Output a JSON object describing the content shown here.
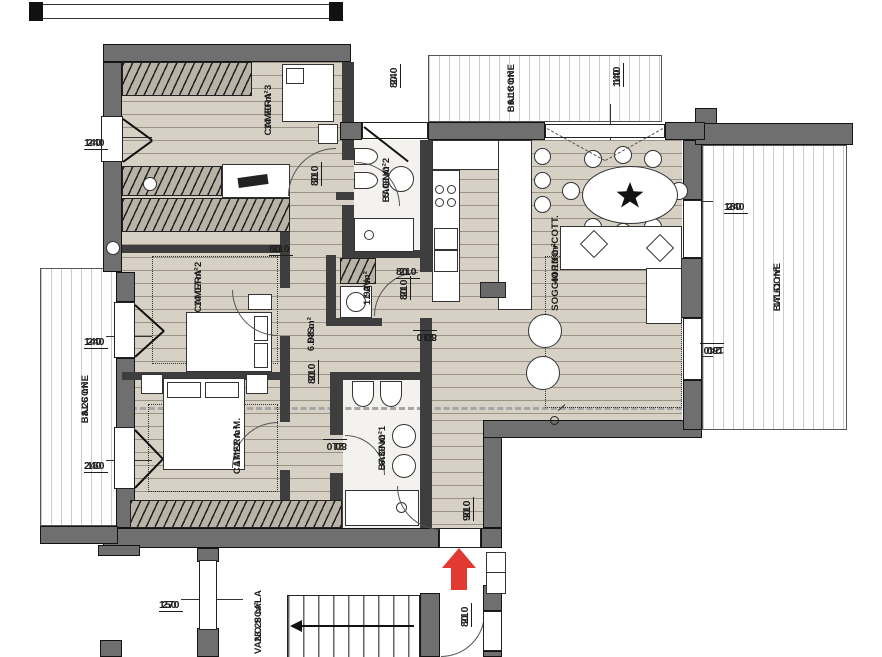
{
  "rooms": [
    {
      "name": "CAMERA 3",
      "area": "14.70 m²"
    },
    {
      "name": "BAGNO 2",
      "area": "5.09 m²"
    },
    {
      "name": "LAV.",
      "area": "1.92 m²"
    },
    {
      "name": "DIS.",
      "area": "6.98 m²"
    },
    {
      "name": "CAMERA 2",
      "area": "14.07 m²"
    },
    {
      "name": "CAMERA M.",
      "area": "17.22 m²"
    },
    {
      "name": "BAGNO 1",
      "area": "6.39 m²"
    },
    {
      "name": "SOGGIORNO+COTT.",
      "area": "44.10 m²"
    },
    {
      "name": "BALCONE",
      "area": "6.18 m²"
    },
    {
      "name": "BALCONE",
      "area": "17.61 m²"
    },
    {
      "name": "BALCONE",
      "area": "8.26 m²"
    },
    {
      "name": "VANO SCALA",
      "area": "23.28 m²"
    }
  ],
  "dims": [
    {
      "w": "240",
      "h": "140"
    },
    {
      "w": "240",
      "h": "80"
    },
    {
      "w": "140",
      "h": "140"
    },
    {
      "w": "240",
      "h": "180"
    },
    {
      "w": "240",
      "h": "180"
    },
    {
      "w": "210",
      "h": "80"
    },
    {
      "w": "210",
      "h": "80"
    },
    {
      "w": "240",
      "h": "140"
    },
    {
      "w": "210",
      "h": "80"
    },
    {
      "w": "210",
      "h": "80"
    },
    {
      "w": "210",
      "h": "80"
    },
    {
      "w": "160",
      "h": "240"
    },
    {
      "w": "210",
      "h": "80"
    },
    {
      "w": "210",
      "h": "80"
    },
    {
      "w": "210",
      "h": "90"
    },
    {
      "w": "270",
      "h": "150"
    },
    {
      "w": "210",
      "h": "80"
    }
  ],
  "markers": {
    "entrance_arrow_direction": "up",
    "stairs_arrow_direction": "left"
  },
  "colors": {
    "wall": "#6f6f6f",
    "partition": "#3e3e3e",
    "floor": "#d7d0c4",
    "balcony_floor": "#ffffff",
    "arrow_red": "#e03a33",
    "line": "#2a2a2a",
    "dash": "#a6a6a6"
  }
}
